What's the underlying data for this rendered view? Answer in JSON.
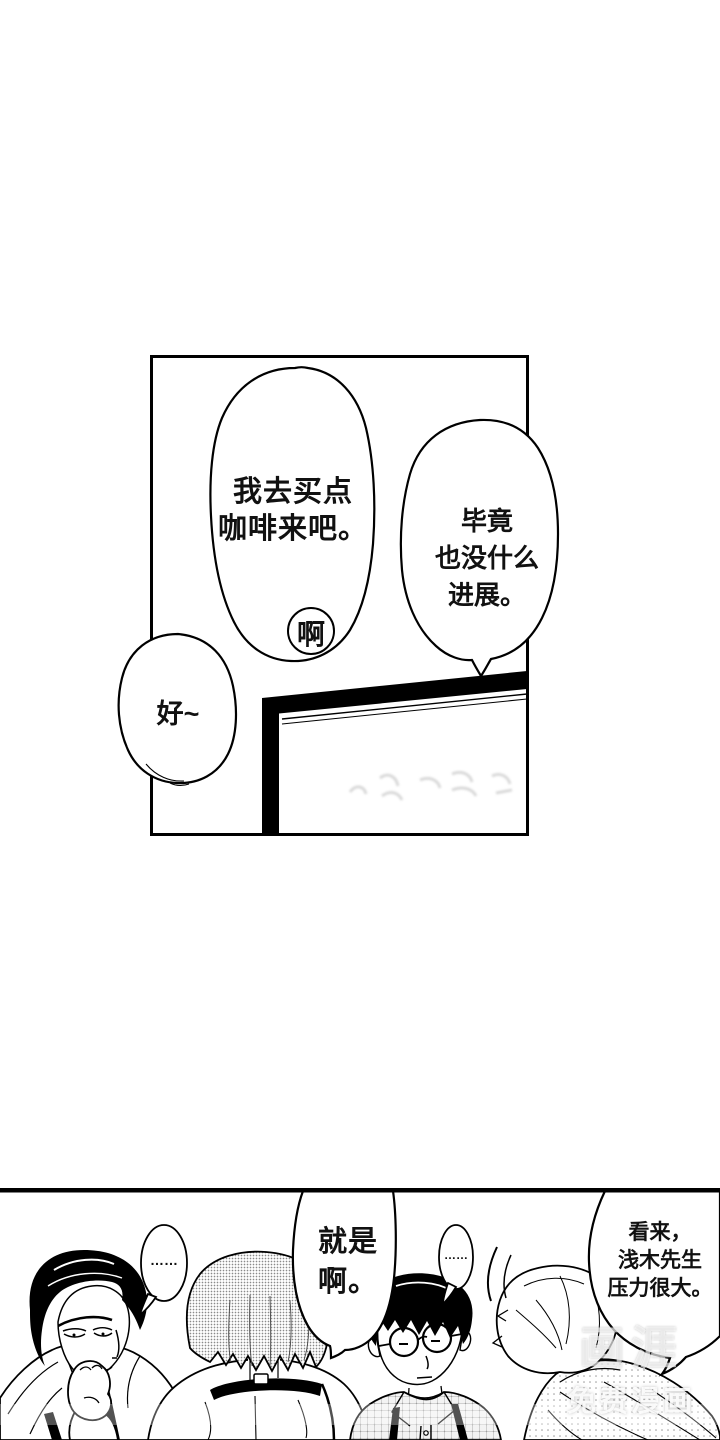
{
  "page": {
    "background": "#ffffff",
    "ink": "#000000",
    "width": 720,
    "height": 1440
  },
  "panel_top": {
    "bubble_coffee": "我去买点\n咖啡来吧。",
    "bubble_ah": "啊",
    "bubble_progress": "毕竟\n也没什么\n进展。",
    "bubble_ok": "好~"
  },
  "panel_bottom": {
    "bubble_dots_left": "……",
    "bubble_agree": "就是\n啊。",
    "bubble_dots_right": "……",
    "bubble_pressure": "看来，\n浅木先生\n压力很大。"
  },
  "watermark": {
    "logo": "画涯",
    "label": "免费漫画"
  },
  "colors": {
    "line_ink": "#000000",
    "tone_gray": "#8a8a8a",
    "ghost_gray": "#b5b5b5",
    "watermark_white": "rgba(255,255,255,0.7)"
  }
}
